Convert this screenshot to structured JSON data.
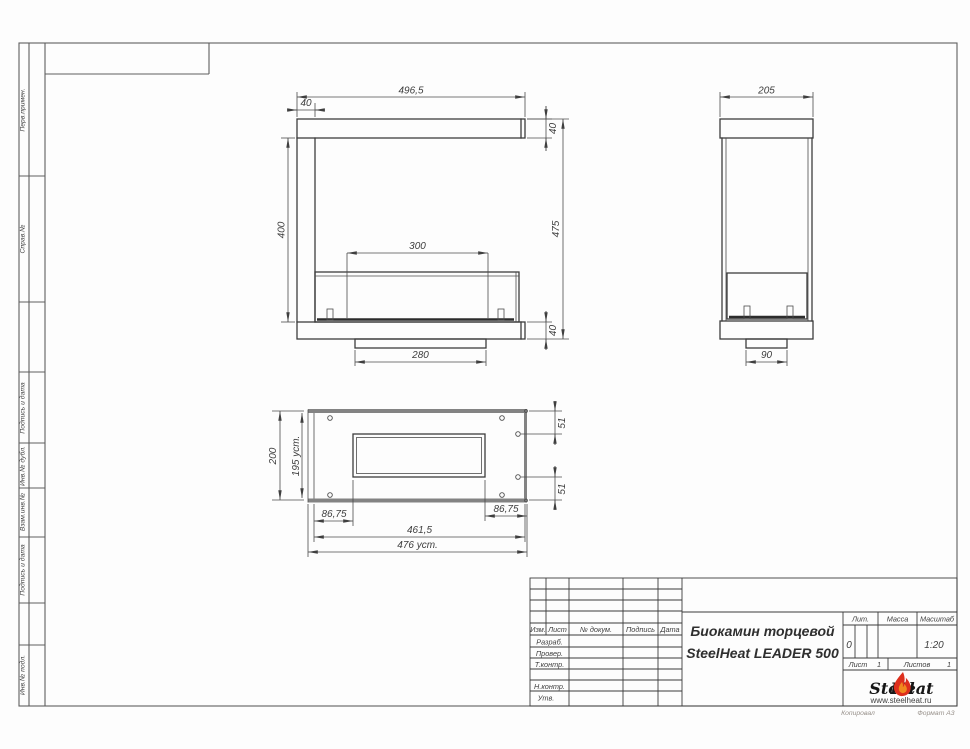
{
  "page": {
    "footer_copy": "Копировал",
    "footer_format": "Формат А3"
  },
  "margin_labels": [
    "Перв.примен.",
    "Справ.№",
    "Подпись и дата",
    "Инв.№ дубл.",
    "Взам.инв.№",
    "Подпись и дата",
    "Инв.№ подл."
  ],
  "drawing": {
    "front_view": {
      "overall_width": "496,5",
      "left_column": "40",
      "top_bar": "40",
      "opening_height": "400",
      "overall_height": "475",
      "burner_width": "300",
      "bottom_bar": "40",
      "base_width": "280"
    },
    "side_view": {
      "overall_depth": "205",
      "base_depth": "90"
    },
    "plan_view": {
      "overall_depth": "200",
      "install_depth": "195 уст.",
      "edge_offset_top": "51",
      "edge_offset_bottom": "51",
      "offset_left": "86,75",
      "offset_right": "86,75",
      "body_length": "461,5",
      "install_length": "476 уст."
    }
  },
  "title_block": {
    "header_cols": [
      "Изм.",
      "Лист",
      "№ докум.",
      "Подпись",
      "Дата"
    ],
    "sign_rows": [
      "Разраб.",
      "Провер.",
      "Т.контр.",
      "Н.контр.",
      "Утв."
    ],
    "doc_title_line1": "Биокамин торцевой",
    "doc_title_line2": "SteelHeat LEADER 500",
    "lit_label": "Лит.",
    "lit_value": "0",
    "mass_label": "Масса",
    "scale_label": "Масштаб",
    "scale_value": "1:20",
    "sheet_label": "Лист",
    "sheet_value": "1",
    "sheets_label": "Листов",
    "sheets_value": "1",
    "logo_steel": "Steel",
    "logo_heat": "Heat",
    "logo_url": "www.steelheat.ru",
    "colors": {
      "flame_red": "#dd2f1d",
      "flame_orange": "#f0891e",
      "url_red": "#c9281e"
    }
  }
}
